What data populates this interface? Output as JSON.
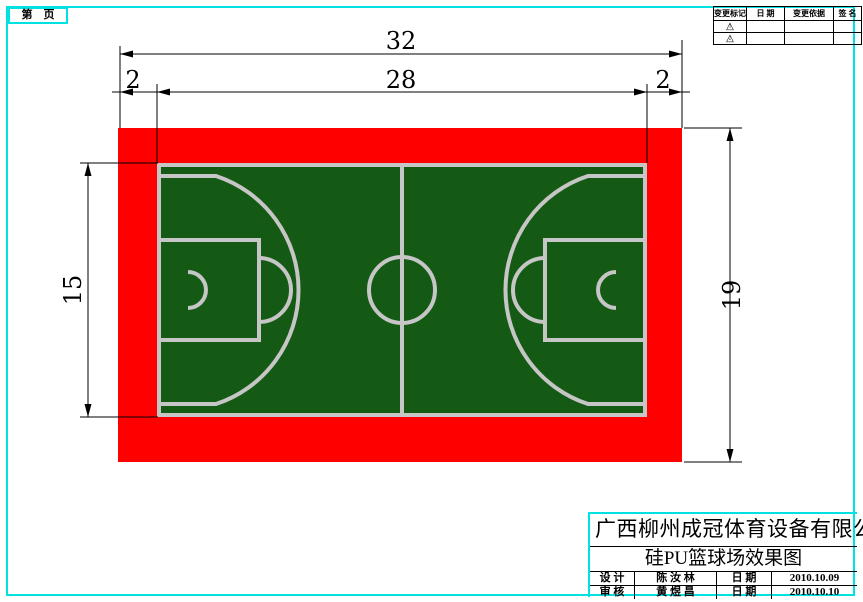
{
  "page": {
    "label_box": "第　页",
    "border_color": "#00e1e1"
  },
  "revision_table": {
    "headers": [
      "变更标记",
      "日 期",
      "变更依据",
      "签 名"
    ],
    "rows": [
      {
        "mark": "△",
        "no": "1",
        "date": "",
        "basis": "",
        "sign": ""
      },
      {
        "mark": "△",
        "no": "2",
        "date": "",
        "basis": "",
        "sign": ""
      }
    ]
  },
  "drawing": {
    "dimensions": {
      "total_width": "32",
      "play_width": "28",
      "margin_left": "2",
      "margin_right": "2",
      "play_height": "15",
      "total_height": "19"
    },
    "colors": {
      "apron_red": "#fe0000",
      "court_green": "#145a14",
      "line_gray": "#c6c6c6",
      "dim_black": "#000000",
      "frame_cyan": "#00e1e1"
    }
  },
  "title_block": {
    "company": "广西柳州成冠体育设备有限公司",
    "drawing_title": "硅PU篮球场效果图",
    "rows": [
      {
        "role": "设 计",
        "name": "陈 汝 林",
        "date_label": "日 期",
        "date": "2010.10.09"
      },
      {
        "role": "审 核",
        "name": "黄 煜 昌",
        "date_label": "日 期",
        "date": "2010.10.10"
      }
    ]
  }
}
